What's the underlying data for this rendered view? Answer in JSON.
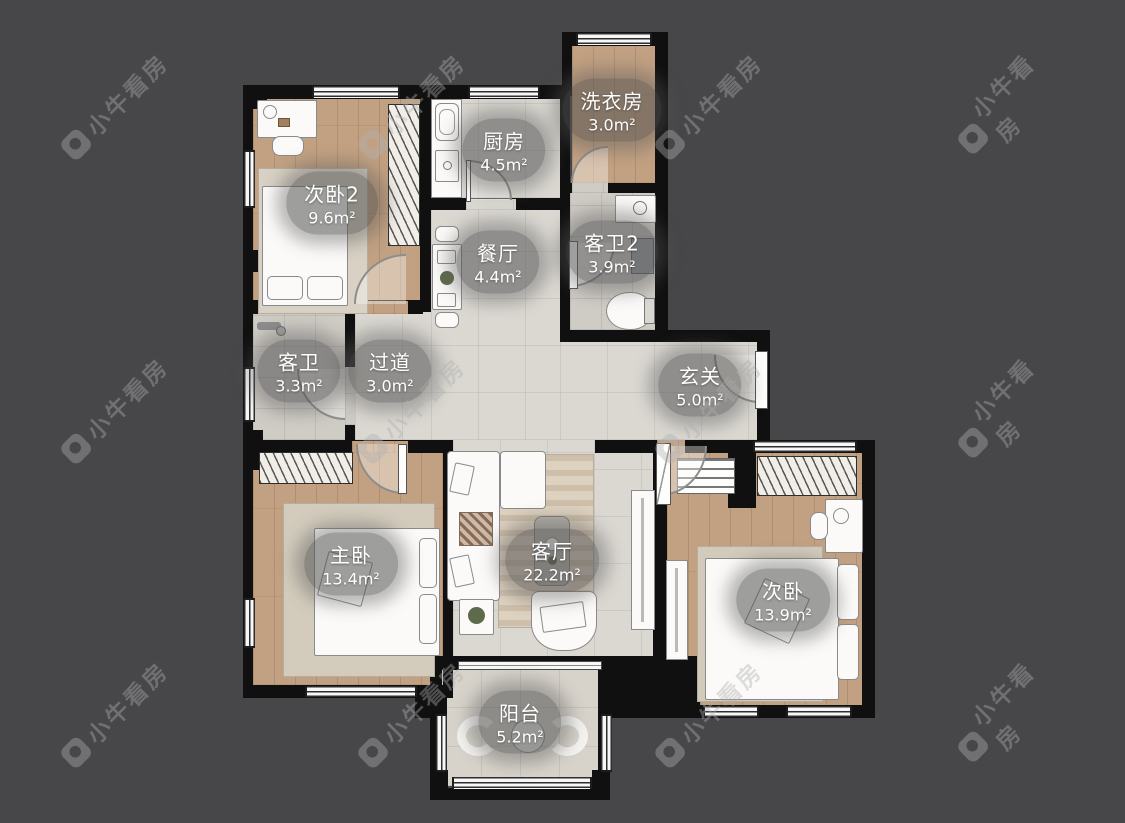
{
  "image_type": "floorplan",
  "watermark": {
    "brand": "小牛看房"
  },
  "rooms": [
    {
      "name": "次卧2",
      "area": "9.6m²"
    },
    {
      "name": "厨房",
      "area": "4.5m²"
    },
    {
      "name": "洗衣房",
      "area": "3.0m²"
    },
    {
      "name": "餐厅",
      "area": "4.4m²"
    },
    {
      "name": "客卫2",
      "area": "3.9m²"
    },
    {
      "name": "客卫",
      "area": "3.3m²"
    },
    {
      "name": "过道",
      "area": "3.0m²"
    },
    {
      "name": "玄关",
      "area": "5.0m²"
    },
    {
      "name": "主卧",
      "area": "13.4m²"
    },
    {
      "name": "客厅",
      "area": "22.2m²"
    },
    {
      "name": "次卧",
      "area": "13.9m²"
    },
    {
      "name": "阳台",
      "area": "5.2m²"
    }
  ],
  "colors": {
    "background": "#47474a",
    "wall": "#101010",
    "wood_floor": "#c2a182",
    "tile_floor": "#dbd8d2",
    "bath_floor": "#cfcbc5",
    "label_bg": "rgba(82,82,82,0.55)",
    "label_text": "#ffffff",
    "watermark": "rgba(175,175,175,0.40)"
  }
}
